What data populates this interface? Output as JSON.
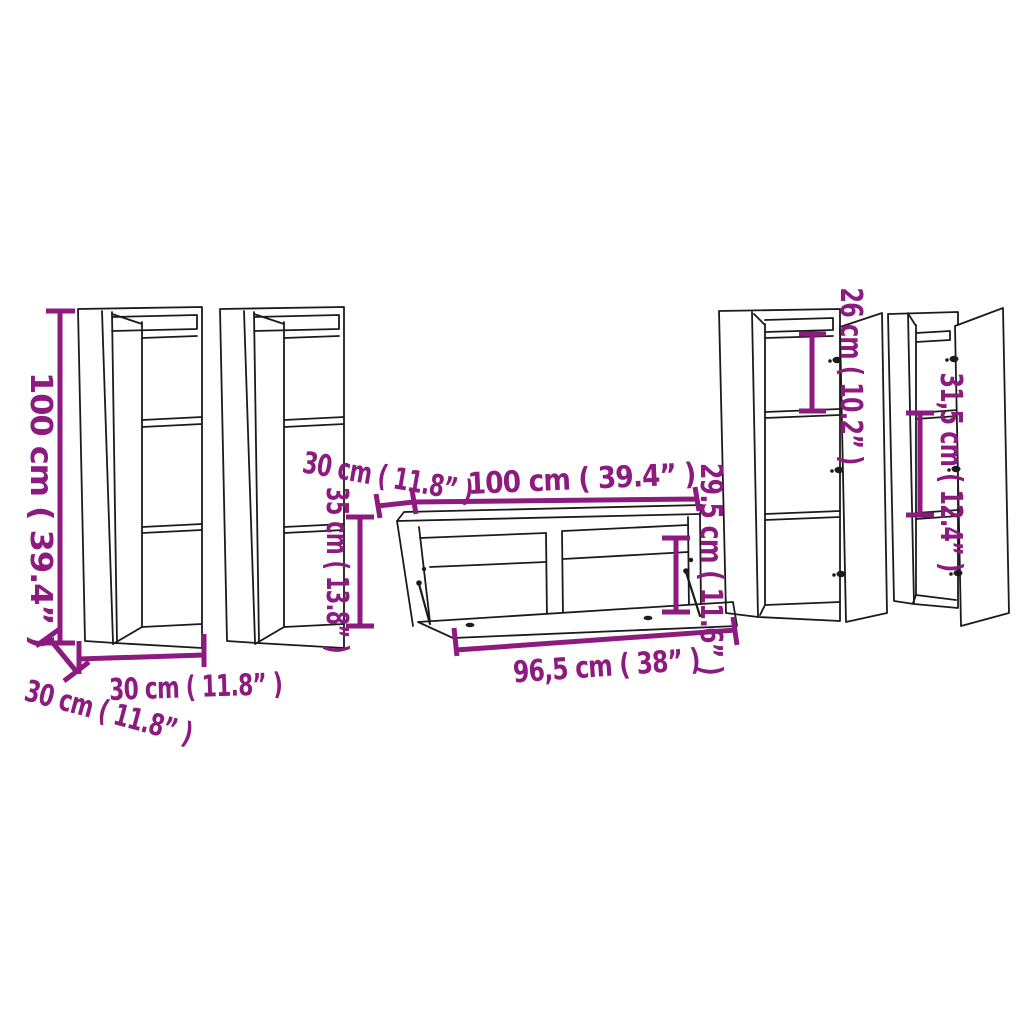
{
  "diagram": {
    "description": "Furniture dimension diagram of a 5-piece wall-mounted TV cabinet set",
    "colors": {
      "dimension": "#8D1A7F",
      "line": "#1b1b1b",
      "background": "#ffffff"
    },
    "dimensions": {
      "left_cabinet": {
        "height": "100 cm ( 39.4” )",
        "width": "30 cm ( 11.8” )",
        "depth": "30 cm ( 11.8” )"
      },
      "tv_stand": {
        "width": "100 cm ( 39.4” )",
        "depth": "30 cm ( 11.8” )",
        "height": "35 cm ( 13.8” )",
        "door_width": "96,5 cm ( 38” )",
        "door_height": "29.5 cm ( 11.6” )"
      },
      "right_cabinets": {
        "upper_compartment": "26 cm ( 10.2” )",
        "middle_compartment": "31,5 cm ( 12.4” )"
      }
    }
  }
}
